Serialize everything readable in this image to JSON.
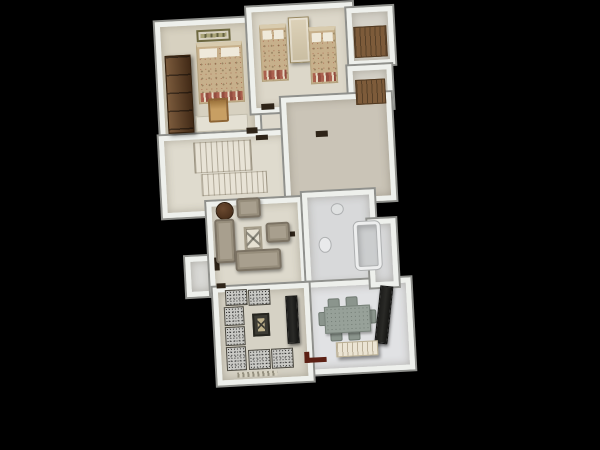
{
  "scene": {
    "plan": {
      "left": 156,
      "top": 4,
      "width": 252,
      "height": 384,
      "rotate_deg": -3
    }
  },
  "palette": {
    "background": "#000000",
    "wall": "#eef0ec",
    "wall_edge": "#8f908c",
    "wood_dark": "#5e3c20",
    "closet_wood": "#7d5b3a",
    "sofa_fabric": "#a89f8e",
    "bed_blanket": "#c7b08b",
    "bed_accent": "#a85848",
    "cushion_speckle": "#c9c9c5",
    "dining_set": "#97a199",
    "dark_panel": "#2a2a27",
    "door_marker": "#2e2418",
    "entry_door": "#5c2014",
    "bathtub": "#cbcdce"
  },
  "rooms": [
    {
      "id": "corridor",
      "x": 96,
      "y": 96,
      "w": 50,
      "h": 48,
      "floor": "#ded9cc"
    },
    {
      "id": "entry-porch",
      "x": 26,
      "y": 248,
      "w": 30,
      "h": 40,
      "floor": "#d9d9d6"
    },
    {
      "id": "bedroom-1",
      "x": 8,
      "y": 12,
      "w": 100,
      "h": 130,
      "floor": "#d7d1c0"
    },
    {
      "id": "bedroom-2",
      "x": 100,
      "y": 2,
      "w": 106,
      "h": 106,
      "floor": "#dcd7c9"
    },
    {
      "id": "closet-1",
      "x": 200,
      "y": 8,
      "w": 46,
      "h": 58,
      "floor": "#d5d2c9"
    },
    {
      "id": "closet-2",
      "x": 198,
      "y": 66,
      "w": 44,
      "h": 44,
      "floor": "#d5d2c9"
    },
    {
      "id": "stair-hall",
      "x": 6,
      "y": 126,
      "w": 132,
      "h": 82,
      "floor": "#dfdbce"
    },
    {
      "id": "large-room",
      "x": 130,
      "y": 94,
      "w": 110,
      "h": 108,
      "floor": "#cac4b7"
    },
    {
      "id": "living-room",
      "x": 50,
      "y": 194,
      "w": 96,
      "h": 94,
      "floor": "#ddd9cc"
    },
    {
      "id": "bathroom",
      "x": 146,
      "y": 190,
      "w": 72,
      "h": 98,
      "floor": "#d8d9da"
    },
    {
      "id": "dining-room",
      "x": 142,
      "y": 280,
      "w": 108,
      "h": 92,
      "floor": "#e1e2e4"
    },
    {
      "id": "bathroom-nook",
      "x": 210,
      "y": 220,
      "w": 28,
      "h": 68,
      "floor": "#d8d9da"
    },
    {
      "id": "majlis-room",
      "x": 52,
      "y": 280,
      "w": 96,
      "h": 98,
      "floor": "#d6d2c5"
    }
  ],
  "furniture": [
    {
      "id": "wardrobe-dark",
      "type": "wardrobe",
      "x": 16,
      "y": 46,
      "w": 26,
      "h": 78
    },
    {
      "id": "wall-art",
      "type": "sign",
      "x": 49,
      "y": 22,
      "w": 34,
      "h": 12
    },
    {
      "id": "double-bed",
      "type": "bed",
      "x": 48,
      "y": 35,
      "w": 46,
      "h": 61
    },
    {
      "id": "desk",
      "type": "desk",
      "x": 44,
      "y": 108,
      "w": 52,
      "h": 16
    },
    {
      "id": "desk-chair",
      "type": "chairseat",
      "x": 57,
      "y": 91,
      "w": 20,
      "h": 24
    },
    {
      "id": "single-bed-1",
      "type": "bed",
      "x": 112,
      "y": 20,
      "w": 27,
      "h": 57
    },
    {
      "id": "bedside-cabinet",
      "type": "cabinet",
      "x": 141,
      "y": 14,
      "w": 21,
      "h": 46
    },
    {
      "id": "single-bed-2",
      "type": "bed",
      "x": 161,
      "y": 25,
      "w": 27,
      "h": 57
    },
    {
      "id": "closet-shelf-1",
      "type": "woodfloor",
      "x": 206,
      "y": 27,
      "w": 33,
      "h": 31
    },
    {
      "id": "closet-shelf-2",
      "type": "woodfloor",
      "x": 205,
      "y": 80,
      "w": 30,
      "h": 25
    },
    {
      "id": "stair-flight-upper",
      "type": "stairs",
      "x": 40,
      "y": 134,
      "w": 58,
      "h": 31
    },
    {
      "id": "stair-flight-lower",
      "type": "stairs",
      "x": 46,
      "y": 166,
      "w": 66,
      "h": 22
    },
    {
      "id": "door-marker-1",
      "type": "door",
      "x": 94,
      "y": 122,
      "w": 11,
      "h": 6
    },
    {
      "id": "door-marker-2",
      "type": "door",
      "x": 103,
      "y": 130,
      "w": 12,
      "h": 5
    },
    {
      "id": "door-marker-3",
      "type": "door",
      "x": 110,
      "y": 99,
      "w": 13,
      "h": 6
    },
    {
      "id": "door-marker-4",
      "type": "door",
      "x": 163,
      "y": 129,
      "w": 12,
      "h": 6
    },
    {
      "id": "door-marker-5",
      "type": "door",
      "x": 55,
      "y": 250,
      "w": 5,
      "h": 13
    },
    {
      "id": "door-marker-6",
      "type": "door",
      "x": 56,
      "y": 276,
      "w": 9,
      "h": 5
    },
    {
      "id": "door-marker-7",
      "type": "door",
      "x": 127,
      "y": 228,
      "w": 10,
      "h": 5
    },
    {
      "id": "round-side-table",
      "type": "roundtable",
      "x": 59,
      "y": 195,
      "w": 18,
      "h": 18
    },
    {
      "id": "armchair-1",
      "type": "sofa",
      "x": 80,
      "y": 192,
      "w": 24,
      "h": 20
    },
    {
      "id": "sofa-left",
      "type": "sofa",
      "x": 57,
      "y": 212,
      "w": 20,
      "h": 44
    },
    {
      "id": "coffee-table",
      "type": "coffeetable",
      "x": 86,
      "y": 221,
      "w": 18,
      "h": 24
    },
    {
      "id": "armchair-2",
      "type": "sofa",
      "x": 108,
      "y": 218,
      "w": 24,
      "h": 20
    },
    {
      "id": "sofa-bottom",
      "type": "sofa",
      "x": 76,
      "y": 244,
      "w": 46,
      "h": 21
    },
    {
      "id": "bathtub",
      "type": "tub",
      "x": 196,
      "y": 222,
      "w": 26,
      "h": 48
    },
    {
      "id": "toilet",
      "type": "oval",
      "x": 160,
      "y": 235,
      "w": 13,
      "h": 16,
      "color": "#e9eaeb"
    },
    {
      "id": "sink",
      "type": "oval",
      "x": 174,
      "y": 202,
      "w": 13,
      "h": 12,
      "color": "#dfe1e1"
    },
    {
      "id": "floor-cushion-1",
      "type": "cushion",
      "x": 64,
      "y": 283,
      "w": 22,
      "h": 16
    },
    {
      "id": "floor-cushion-2",
      "type": "cushion",
      "x": 87,
      "y": 284,
      "w": 22,
      "h": 16
    },
    {
      "id": "floor-cushion-3",
      "type": "cushion",
      "x": 62,
      "y": 300,
      "w": 20,
      "h": 19
    },
    {
      "id": "floor-cushion-4",
      "type": "cushion",
      "x": 62,
      "y": 320,
      "w": 20,
      "h": 19
    },
    {
      "id": "floor-cushion-5",
      "type": "cushion",
      "x": 62,
      "y": 340,
      "w": 20,
      "h": 24
    },
    {
      "id": "floor-cushion-6",
      "type": "cushion",
      "x": 84,
      "y": 344,
      "w": 22,
      "h": 20
    },
    {
      "id": "floor-cushion-7",
      "type": "cushion",
      "x": 107,
      "y": 344,
      "w": 22,
      "h": 20
    },
    {
      "id": "majlis-table",
      "type": "darktable",
      "x": 90,
      "y": 308,
      "w": 17,
      "h": 23
    },
    {
      "id": "tv-panel",
      "type": "tv",
      "x": 124,
      "y": 292,
      "w": 12,
      "h": 48
    },
    {
      "id": "rug-fringe",
      "type": "fringe",
      "x": 72,
      "y": 366,
      "w": 40,
      "h": 5
    },
    {
      "id": "dining-chair-1",
      "type": "dchair",
      "x": 166,
      "y": 297,
      "w": 12,
      "h": 11
    },
    {
      "id": "dining-chair-2",
      "type": "dchair",
      "x": 184,
      "y": 296,
      "w": 12,
      "h": 11
    },
    {
      "id": "dining-chair-3",
      "type": "dchair",
      "x": 167,
      "y": 329,
      "w": 12,
      "h": 11
    },
    {
      "id": "dining-chair-4",
      "type": "dchair",
      "x": 185,
      "y": 329,
      "w": 12,
      "h": 11
    },
    {
      "id": "dining-chair-5",
      "type": "dchair",
      "x": 156,
      "y": 310,
      "w": 9,
      "h": 14
    },
    {
      "id": "dining-chair-6",
      "type": "dchair",
      "x": 205,
      "y": 310,
      "w": 9,
      "h": 14
    },
    {
      "id": "dining-table",
      "type": "dtable",
      "x": 162,
      "y": 305,
      "w": 46,
      "h": 27
    },
    {
      "id": "sideboard",
      "type": "tv",
      "x": 215,
      "y": 287,
      "w": 13,
      "h": 58,
      "rot": 9
    },
    {
      "id": "bench",
      "type": "bench",
      "x": 172,
      "y": 341,
      "w": 42,
      "h": 15
    },
    {
      "id": "entry-door-marker",
      "type": "doorred",
      "x": 140,
      "y": 349,
      "w": 22,
      "h": 11
    }
  ]
}
